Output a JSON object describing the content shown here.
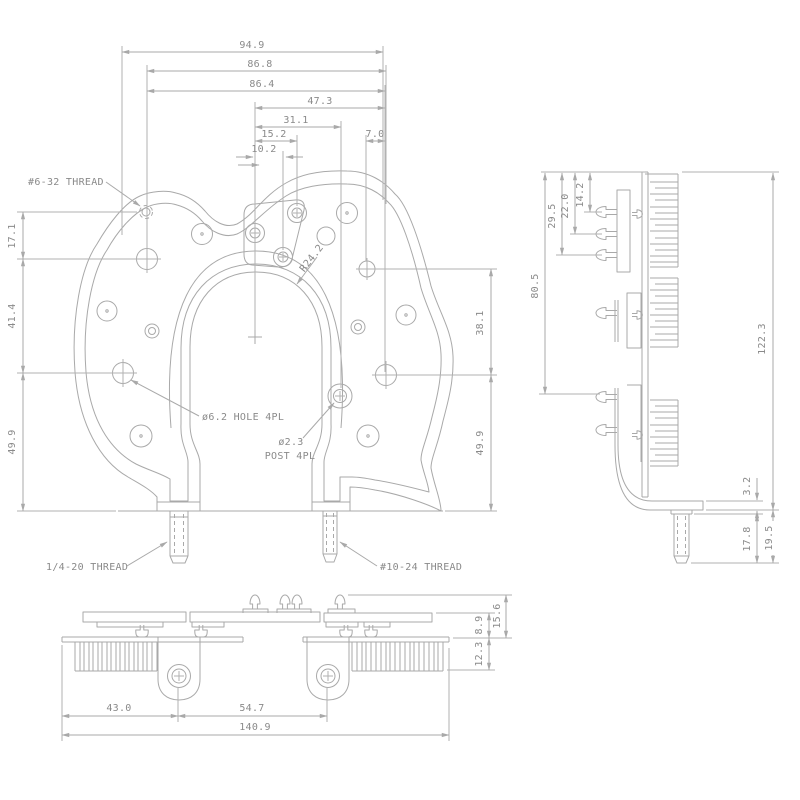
{
  "drawing_type": "engineering-drawing",
  "colors": {
    "line": "#a9a9a9",
    "text": "#8a8a8a",
    "background": "#ffffff"
  },
  "front_view": {
    "dims_top": [
      "94.9",
      "86.8",
      "86.4",
      "47.3",
      "31.1",
      "15.2",
      "10.2",
      "7.0"
    ],
    "dims_left": [
      "17.1",
      "41.4",
      "49.9"
    ],
    "dims_right": [
      "38.1",
      "49.9"
    ],
    "labels": {
      "thread_hole": "#6-32 THREAD",
      "hole_callout": "ø6.2 HOLE 4PL",
      "post_callout_dia": "ø2.3",
      "post_callout_qty": "POST 4PL",
      "radius_callout": "R24.2",
      "left_stud": "1/4-20 THREAD",
      "right_stud": "#10-24 THREAD"
    }
  },
  "side_view": {
    "dims_left": [
      "80.5",
      "29.5",
      "22.0",
      "14.2"
    ],
    "dims_right": [
      "122.3",
      "3.2",
      "17.8",
      "19.5"
    ]
  },
  "bottom_view": {
    "dims_bottom": [
      "43.0",
      "54.7",
      "140.9"
    ],
    "dims_right": [
      "15.6",
      "8.9",
      "12.3"
    ]
  }
}
